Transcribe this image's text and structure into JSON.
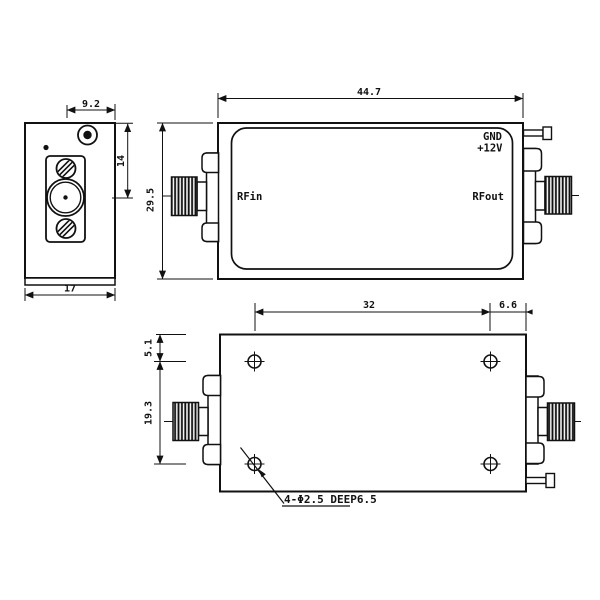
{
  "colors": {
    "line": "#111111",
    "background": "#ffffff"
  },
  "front_view": {
    "dim_connector_to_edge": "9.2",
    "dim_top_to_center": "14",
    "dim_width": "17"
  },
  "top_view": {
    "dim_width": "44.7",
    "dim_height": "29.5",
    "label_gnd": "GND",
    "label_12v": "+12V",
    "label_rf_in": "RFin",
    "label_rf_out": "RFout"
  },
  "bottom_view": {
    "dim_hole_span": "32",
    "dim_hole_to_edge": "6.6",
    "dim_top_to_hole": "5.1",
    "dim_hole_rows": "19.3",
    "hole_note": "4-Φ2.5 DEEP6.5"
  }
}
